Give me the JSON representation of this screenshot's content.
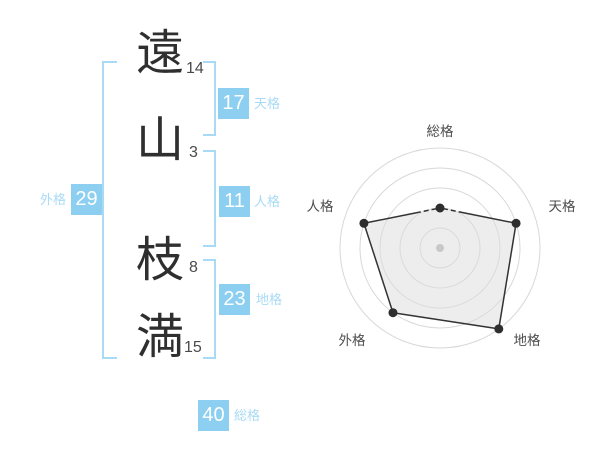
{
  "page": {
    "background": "#ffffff",
    "accent_color": "#8ccff1",
    "accent_light": "#a8daf5"
  },
  "name_display": {
    "characters": [
      {
        "char": "遠",
        "strokes": "14"
      },
      {
        "char": "山",
        "strokes": "3"
      },
      {
        "char": "枝",
        "strokes": "8"
      },
      {
        "char": "満",
        "strokes": "15"
      }
    ],
    "kaku": {
      "tenkaku": {
        "value": "17",
        "label": "天格"
      },
      "jinkaku": {
        "value": "11",
        "label": "人格"
      },
      "chikaku": {
        "value": "23",
        "label": "地格"
      },
      "gaikaku": {
        "value": "29",
        "label": "外格"
      },
      "soukaku": {
        "value": "40",
        "label": "総格"
      }
    }
  },
  "chart_data": {
    "type": "radar",
    "axes": [
      "総格",
      "天格",
      "地格",
      "外格",
      "人格"
    ],
    "series": [
      {
        "name": "格の運勢",
        "values": [
          40,
          80,
          100,
          80,
          80
        ]
      }
    ],
    "max": 100,
    "ring_values": [
      20,
      40,
      60,
      80,
      100
    ],
    "grid_shape": "circular",
    "start_angle_deg": 90,
    "direction": "clockwise",
    "legend": "none",
    "segment_dash": [
      "0 3 5 3 5 3 999",
      null,
      null,
      null,
      "58 3 5 3 5 3"
    ],
    "colors": {
      "grid": "#d8d8d8",
      "line": "#333333",
      "point": "#2e2e2e",
      "fill": "#dcdcdc",
      "center_dot": "#c8c8c8",
      "label": "#4d4d4d"
    }
  }
}
